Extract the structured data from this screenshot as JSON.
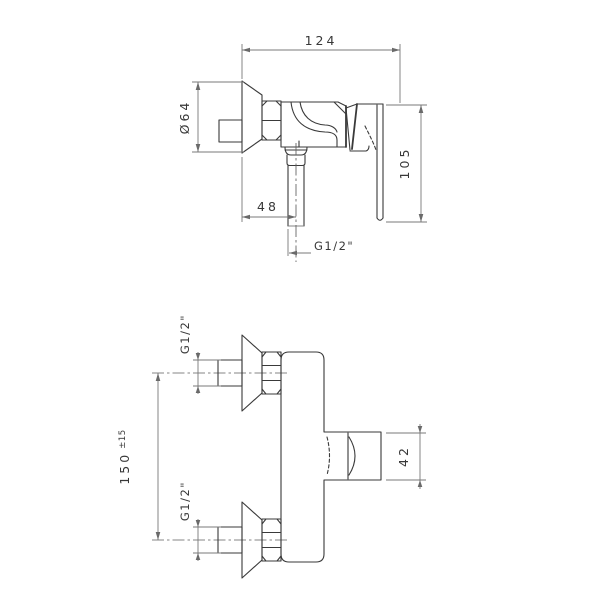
{
  "drawing_type": "technical dimension drawing, wall-mounted single-lever shower mixer, two orthographic views",
  "colors": {
    "background": "#ffffff",
    "outline": "#3a3a3a",
    "dimension_lines": "#787878",
    "text": "#383838"
  },
  "labels": {
    "side": {
      "overall": "124",
      "flange": "Ø64",
      "height": "105",
      "outlet_offset": "48",
      "outlet_thread": "G1/2\""
    },
    "front": {
      "centers": "150",
      "tolerance": "±15",
      "top_thread": "G1/2\"",
      "bottom_thread": "G1/2\"",
      "body": "42"
    }
  }
}
